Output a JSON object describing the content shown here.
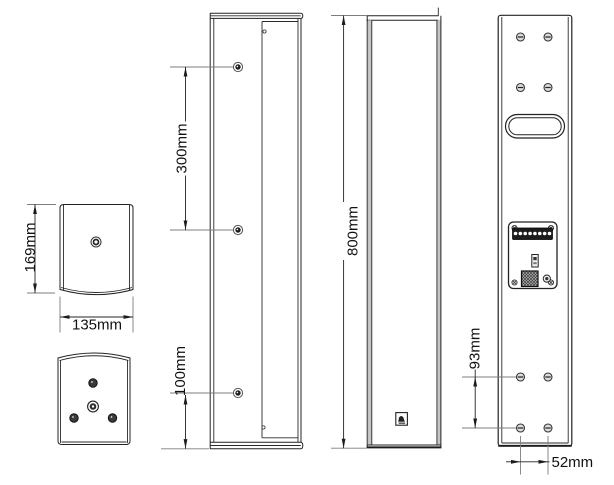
{
  "colors": {
    "background": "#ffffff",
    "line": "#232323",
    "extension_line": "#7d7d7d",
    "text": "#111111",
    "wall_shade": "#c4c4c4",
    "hole_fill": "#3a3a3a",
    "terminal_strip": "#1c1c1c"
  },
  "dimensions": {
    "top_view_height": "169mm",
    "top_view_width": "135mm",
    "side_hole_spacing": "300mm",
    "side_bottom_offset": "100mm",
    "front_height": "800mm",
    "rear_row_spacing": "93mm",
    "rear_col_spacing": "52mm"
  }
}
